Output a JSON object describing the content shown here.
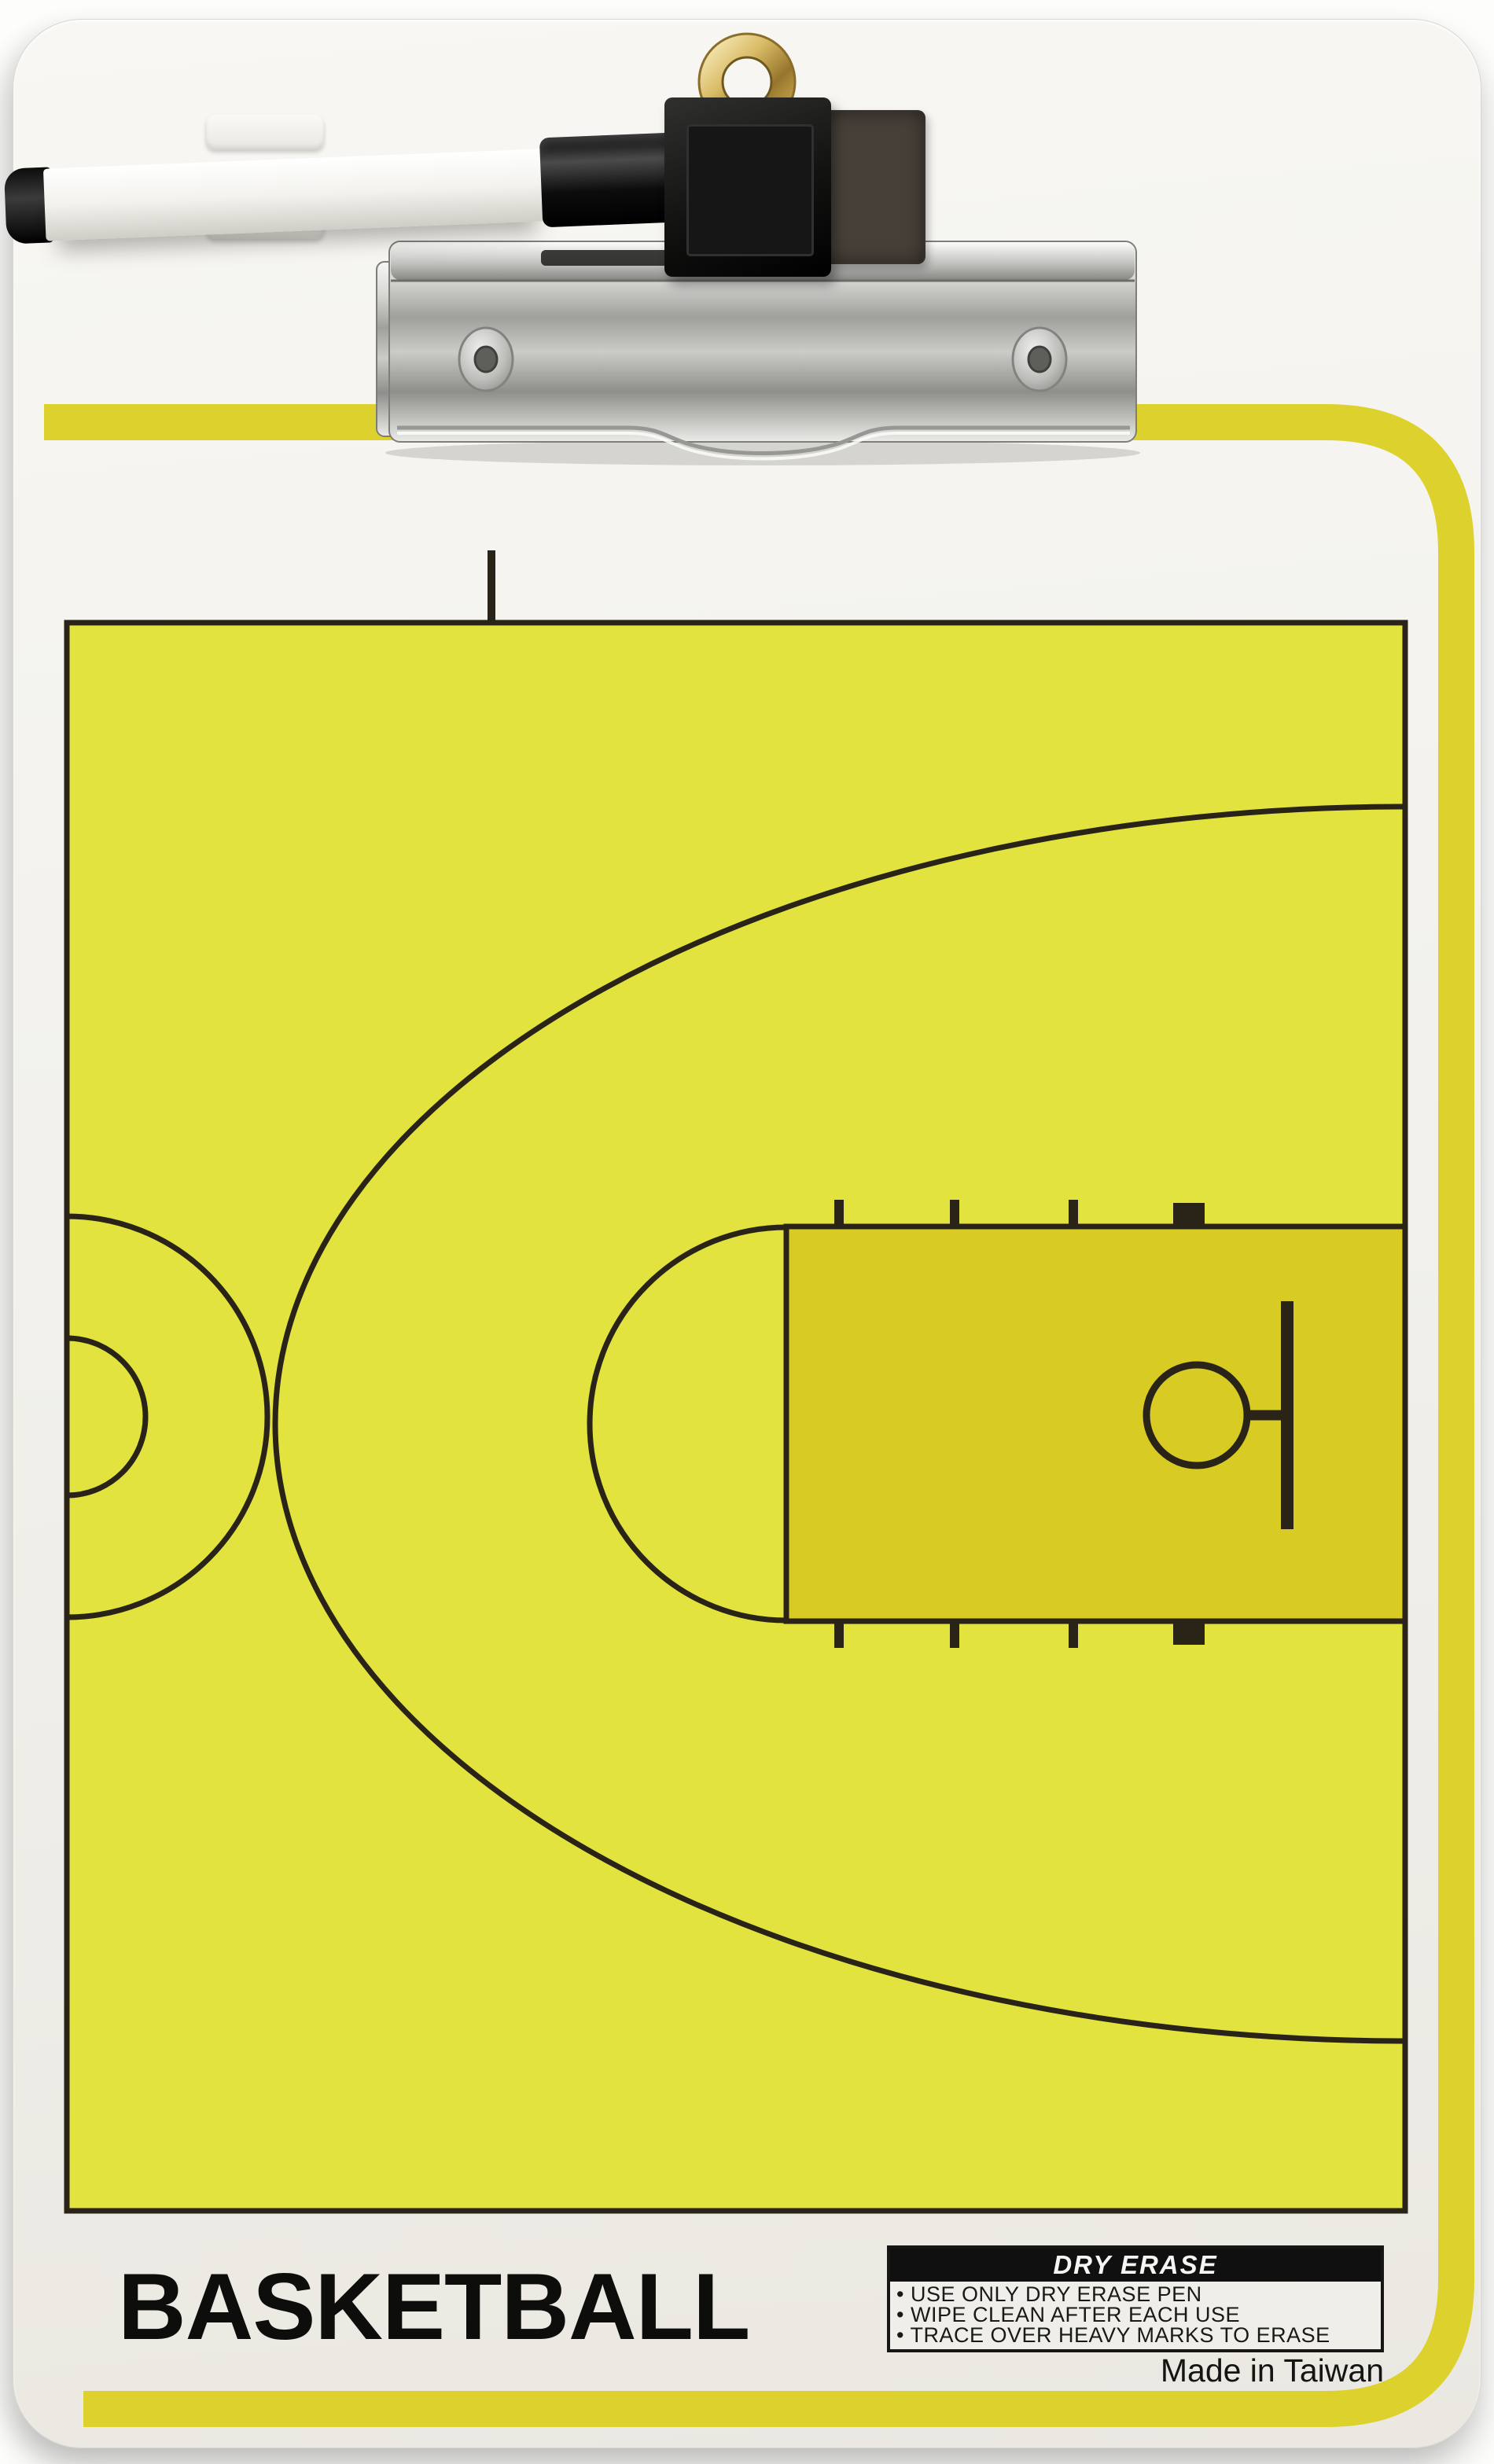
{
  "product": {
    "title": "BASKETBALL",
    "origin": "Made in Taiwan"
  },
  "care_panel": {
    "header": "DRY ERASE",
    "instructions": [
      "• USE ONLY DRY ERASE PEN",
      "• WIPE CLEAN AFTER EACH USE",
      "• TRACE OVER HEAVY MARKS TO ERASE"
    ]
  },
  "colors": {
    "court_yellow": "#e2e33f",
    "lane_yellow": "#d8cb24",
    "stripe_yellow": "#ddd12d",
    "line_black": "#2a2318",
    "board_white": "#f2f1ec",
    "brass": "#c9a84e",
    "clip_metal": "#c7c7c4",
    "pen_barrel_white": "#f3f2ed",
    "felt_gray": "#474039"
  },
  "hardware": {
    "clip": "metal-spring-clip",
    "grommet": "brass-hang-ring",
    "pen": "dry-erase-pen",
    "eraser": "felt-eraser-pad",
    "pen_tabs": "pen-retainer-tabs"
  },
  "court": {
    "type": "half-court-diagram",
    "elements": [
      "court-boundary",
      "half-court-tick",
      "center-circle-outer",
      "center-circle-inner",
      "three-point-arc",
      "free-throw-lane",
      "free-throw-semicircle",
      "lane-hash-marks",
      "rim-circle",
      "rim-connector",
      "backboard-line"
    ]
  }
}
